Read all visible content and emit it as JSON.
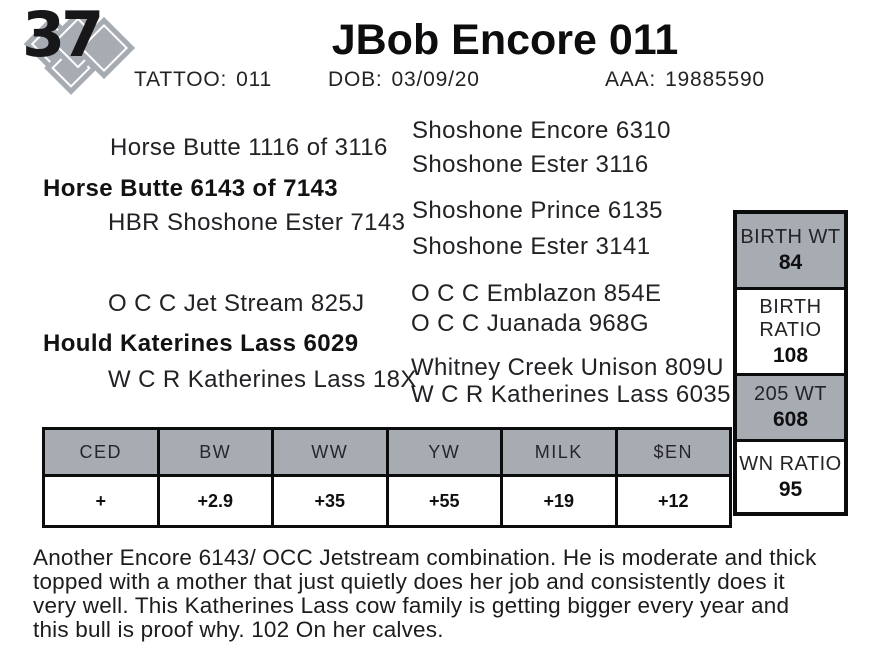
{
  "colors": {
    "shaded_gray": "#a7acb3",
    "border_black": "#0c0c0c",
    "text": "#1e1e1e"
  },
  "lot": {
    "number": "37"
  },
  "header": {
    "title": "JBob Encore 011",
    "tattoo_label": "TATTOO:",
    "tattoo_value": "011",
    "dob_label": "DOB:",
    "dob_value": "03/09/20",
    "aaa_label": "AAA:",
    "aaa_value": "19885590"
  },
  "pedigree": {
    "sire_line": {
      "grandsire": "Horse Butte 1116 of 3116",
      "parent": "Horse Butte 6143 of 7143",
      "granddam": "HBR Shoshone Ester 7143",
      "ggparents": [
        "Shoshone Encore 6310",
        "Shoshone Ester 3116",
        "Shoshone Prince 6135",
        "Shoshone Ester 3141"
      ]
    },
    "dam_line": {
      "grandsire": "O C C Jet Stream 825J",
      "parent": "Hould Katerines Lass 6029",
      "granddam": "W C R Katherines Lass 18X",
      "ggparents": [
        "O C C Emblazon 854E",
        "O C C Juanada 968G",
        "Whitney Creek Unison 809U",
        "W C R  Katherines Lass 6035"
      ]
    }
  },
  "stats": {
    "cells": [
      {
        "label": "BIRTH WT",
        "value": "84"
      },
      {
        "label": "BIRTH RATIO",
        "value": "108"
      },
      {
        "label": "205 WT",
        "value": "608"
      },
      {
        "label": "WN RATIO",
        "value": "95"
      }
    ]
  },
  "epd": {
    "headers": [
      "CED",
      "BW",
      "WW",
      "YW",
      "MILK",
      "$EN"
    ],
    "values": [
      "+",
      "+2.9",
      "+35",
      "+55",
      "+19",
      "+12"
    ]
  },
  "description": {
    "full": "Another Encore 6143/ OCC Jetstream combination. He is moderate and thick topped with a mother that just quietly does her job and consistently does it very well. This Katherines Lass cow family is getting bigger every year and this bull is proof why. 102 On her calves.",
    "lines": [
      "Another Encore 6143/ OCC Jetstream combination. He is moderate and thick",
      "topped with a mother that just quietly does her job and consistently does it",
      "very well. This Katherines Lass cow family is getting bigger every year and",
      "this bull is proof why. 102 On her calves."
    ]
  }
}
